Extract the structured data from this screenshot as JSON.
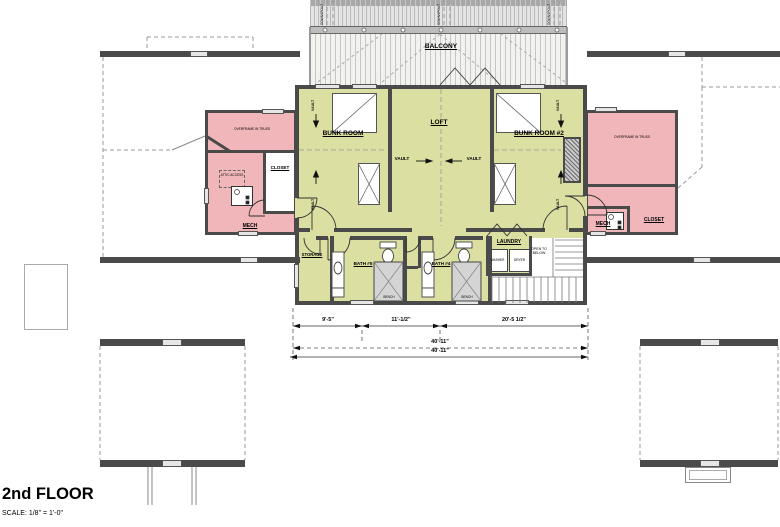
{
  "title": {
    "name": "2nd FLOOR",
    "scale": "SCALE: 1/8\" = 1'-0\""
  },
  "rooms": {
    "balcony": "BALCONY",
    "bunk_room": "BUNK ROOM",
    "loft": "LOFT",
    "bunk_room_2": "BUNK ROOM #2",
    "closet": "CLOSET",
    "mech": "MECH",
    "storage": "STORAGE",
    "bath5": "BATH #5",
    "bath4": "BATH #4",
    "laundry": "LAUNDRY"
  },
  "notes": {
    "overframe": "OVERFRAME IN TRUSS",
    "vault": "VAULT",
    "open_to_below": "OPEN TO BELOW",
    "downspout": "DOWNSPOUT",
    "attic_access": "ATTIC ACCESS"
  },
  "fixtures": {
    "washer": "WASHER",
    "dryer": "DRYER",
    "bench": "BENCH"
  },
  "dimensions": {
    "seg1": "9'-5\"",
    "seg2": "11'-1/2\"",
    "seg3": "20'-5 1/2\"",
    "overall_1": "40'-11\"",
    "overall_2": "40'-11\""
  },
  "colors": {
    "room_fill": "#dcdfa2",
    "attic_fill": "#f1b6b9",
    "wall": "#4a4a4a"
  }
}
